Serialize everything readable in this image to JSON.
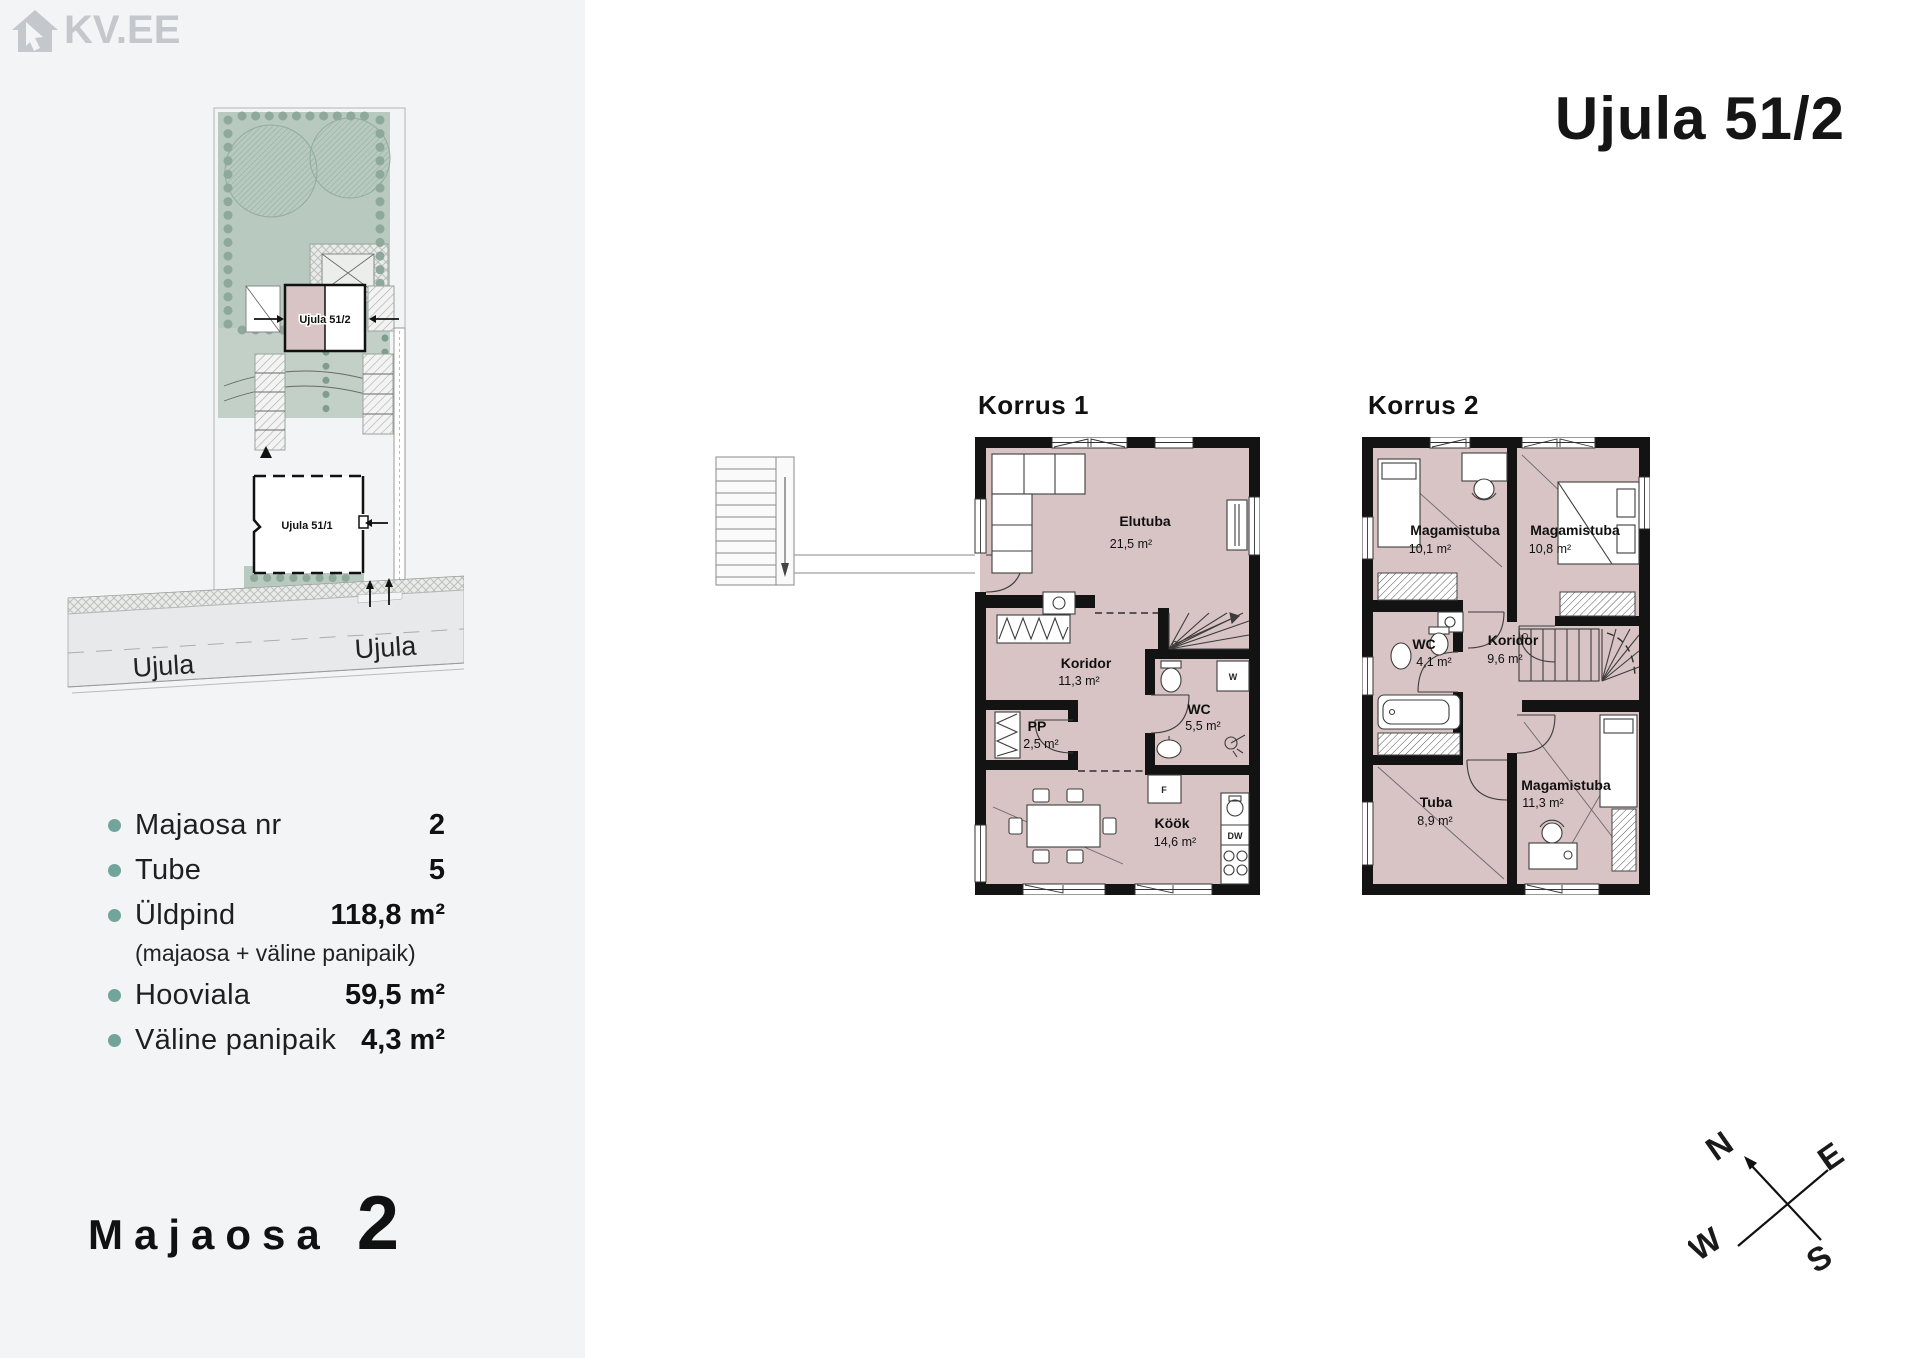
{
  "brand": {
    "logo_text": "KV.EE"
  },
  "sidebar": {
    "site_plan": {
      "unit_label": "Ujula 51/2",
      "neighbor_label": "Ujula 51/1",
      "street_left": "Ujula",
      "street_right": "Ujula"
    },
    "details": [
      {
        "label": "Majaosa nr",
        "value": "2"
      },
      {
        "label": "Tube",
        "value": "5"
      },
      {
        "label": "Üldpind",
        "value": "118,8 m²"
      },
      {
        "label": "Hooviala",
        "value": "59,5 m²"
      },
      {
        "label": "Väline panipaik",
        "value": "4,3 m²"
      }
    ],
    "uldpind_note": "(majaosa + väline panipaik)",
    "footer": {
      "label": "Majaosa",
      "number": "2"
    }
  },
  "main": {
    "title": "Ujula 51/2",
    "floor1": {
      "name": "Korrus 1",
      "rooms": {
        "elutuba": {
          "name": "Elutuba",
          "area": "21,5 m²"
        },
        "koridor": {
          "name": "Koridor",
          "area": "11,3 m²"
        },
        "pp": {
          "name": "PP",
          "area": "2,5 m²"
        },
        "wc": {
          "name": "WC",
          "area": "5,5 m²"
        },
        "kook": {
          "name": "Köök",
          "area": "14,6 m²"
        }
      },
      "appliances": {
        "washer": "W",
        "fridge": "F",
        "dishwasher": "DW"
      }
    },
    "floor2": {
      "name": "Korrus 2",
      "rooms": {
        "mag1": {
          "name": "Magamistuba",
          "area": "10,1 m²"
        },
        "mag2": {
          "name": "Magamistuba",
          "area": "10,8 m²"
        },
        "wc": {
          "name": "WC",
          "area": "4,1 m²"
        },
        "koridor": {
          "name": "Koridor",
          "area": "9,6 m²"
        },
        "tuba": {
          "name": "Tuba",
          "area": "8,9 m²"
        },
        "mag3": {
          "name": "Magamistuba",
          "area": "11,3 m²"
        }
      }
    },
    "compass": {
      "n": "N",
      "e": "E",
      "s": "S",
      "w": "W"
    }
  },
  "colors": {
    "room_fill": "#d8c4c4",
    "accent_teal": "#72a49c",
    "garden_green": "#b8c9bf",
    "logo_gray": "#c4c7cb",
    "sidebar_bg": "#f3f4f6"
  }
}
